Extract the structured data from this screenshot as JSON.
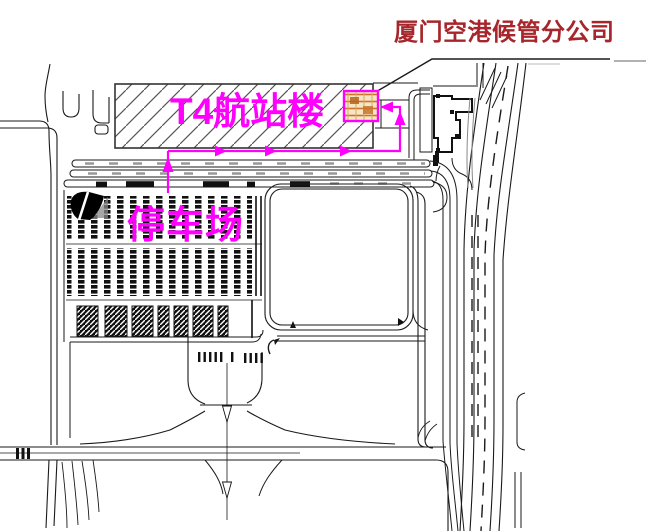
{
  "labels": {
    "company": "厦门空港候管分公司",
    "terminal": "T4航站楼",
    "parking": "停车场"
  },
  "colors": {
    "annotation_magenta": "#FF00FF",
    "title_red": "#A6262B",
    "drawing_ink": "#1A1A1A",
    "office_highlight_fill": "#F5E7C6",
    "office_highlight_hatch": "#C8742C"
  }
}
